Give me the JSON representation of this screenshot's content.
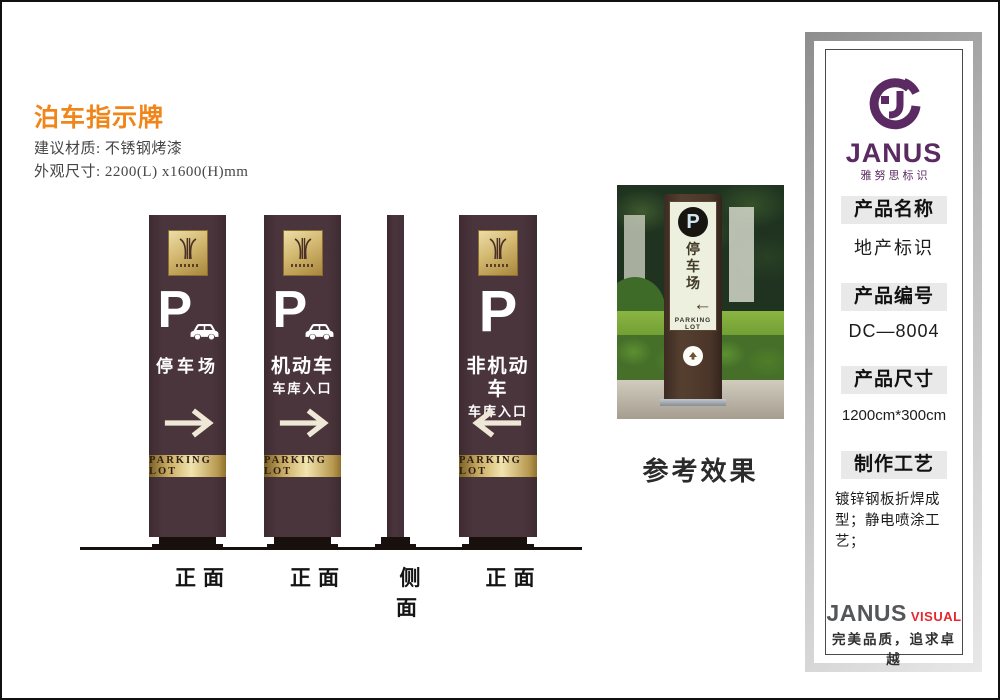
{
  "doc": {
    "title": "泊车指示牌",
    "material": "建议材质: 不锈钢烤漆",
    "size": "外观尺寸: 2200(L) x1600(H)mm"
  },
  "signs": [
    {
      "label": "正面",
      "p": "P",
      "line1": "停车场",
      "line2": "",
      "band": "PARKING LOT",
      "arrow": "right"
    },
    {
      "label": "正面",
      "p": "P",
      "line1": "机动车",
      "line2": "车库入口",
      "band": "PARKING LOT",
      "arrow": "right"
    },
    {
      "label": "侧面"
    },
    {
      "label": "正面",
      "p": "P",
      "line1": "非机动车",
      "line2": "车库入口",
      "band": "PARKING LOT",
      "arrow": "left"
    }
  ],
  "photo": {
    "caption": "参考效果",
    "sign_p": "P",
    "sign_chars": [
      "停",
      "车",
      "场"
    ],
    "sign_band": "PARKING LOT"
  },
  "sidebar": {
    "brand": {
      "name": "JANUS",
      "sub": "雅努思标识"
    },
    "sections": [
      {
        "header": "产品名称",
        "value": "地产标识"
      },
      {
        "header": "产品编号",
        "value": "DC—8004"
      },
      {
        "header": "产品尺寸",
        "value": "1200cm*300cm"
      },
      {
        "header": "制作工艺",
        "value": "镀锌钢板折焊成型；静电喷涂工艺；"
      }
    ],
    "footer": {
      "brand": "JANUS",
      "suffix": "VISUAL",
      "slogan": "完美品质，追求卓越"
    }
  },
  "colors": {
    "pillar": "#4b353c",
    "gold_light": "#f2e4ae",
    "gold_dark": "#8a6d2f",
    "accent_orange": "#f08519",
    "brand_purple": "#5b2a63",
    "brand_red": "#e8262d"
  }
}
